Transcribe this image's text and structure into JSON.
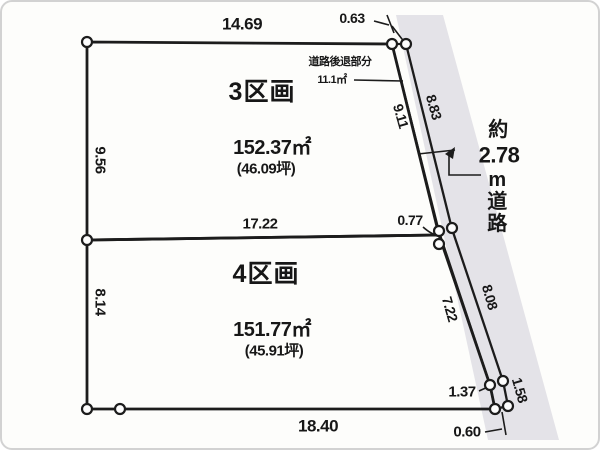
{
  "diagram": {
    "type": "land-plot-survey",
    "parcels": [
      {
        "name": "3区画",
        "area": "152.37㎡",
        "area_tsubo": "(46.09坪)"
      },
      {
        "name": "4区画",
        "area": "151.77㎡",
        "area_tsubo": "(45.91坪)"
      }
    ],
    "dims": {
      "top": "14.69",
      "left_upper": "9.56",
      "divider": "17.22",
      "left_lower": "8.14",
      "bottom": "18.40",
      "road_inner_upper": "9.11",
      "road_inner_lower": "7.22",
      "road_outer_upper": "8.83",
      "road_outer_lower": "8.08",
      "tick_top": "0.63",
      "tick_mid": "0.77",
      "tick_lower": "1.37",
      "tick_outer_lower": "1.58",
      "tick_bottom": "0.60"
    },
    "road": {
      "note_line1": "道路後退部分",
      "note_line2": "11.1㎡",
      "width_prefix": "約",
      "width_value": "2.78",
      "unit_chars": [
        "m",
        "道",
        "路"
      ]
    },
    "colors": {
      "parcel_fill": "#d8e9d3",
      "road_strip_fill": "#d5dad3",
      "road_band_fill": "#e4e3e8",
      "line": "#1c1c1c"
    }
  }
}
